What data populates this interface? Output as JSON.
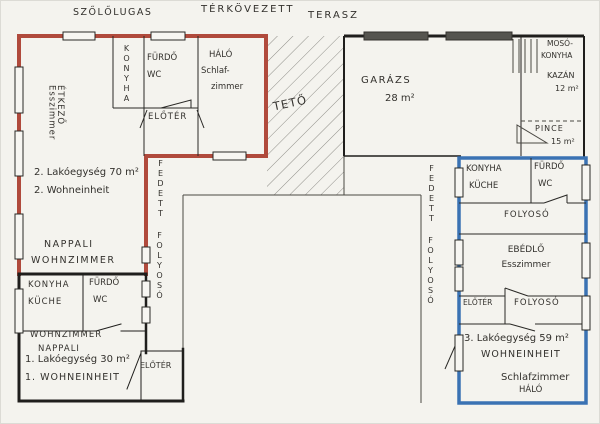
{
  "drawing": {
    "kind": "hand-drawn floor plan",
    "colors": {
      "unit2_outline": "#b04a3c",
      "unit3_outline": "#3a72b3",
      "black_walls": "#1f1e1c",
      "paper": "#f4f3ee",
      "roof_hatch": "#8f8e88",
      "garage_door_fill": "#55544f"
    },
    "outdoor": {
      "pergola": "SZŐLŐLUGAS",
      "paving": "TÉRKÖVEZETT",
      "terrace": "TERASZ",
      "roof": "TETŐ",
      "corridor_left_1": "FEDETT",
      "corridor_left_2": "FOLYOSÓ",
      "corridor_right_1": "FEDETT",
      "corridor_right_2": "FOLYOSÓ"
    },
    "unit2": {
      "kitchen": "KONYHA",
      "bath_1": "FÜRDŐ",
      "bath_2": "WC",
      "bedroom_1": "HÁLÓ",
      "bedroom_2": "Schlaf-",
      "bedroom_3": "zimmer",
      "dining_hu": "ÉTKEZŐ",
      "dining_de": "Esszimmer",
      "hall": "ELŐTÉR",
      "title_1": "2. Lakóegység 70 m²",
      "title_2": "2. Wohneinheit",
      "living_1": "NAPPALI",
      "living_2": "WOHNZIMMER"
    },
    "unit1": {
      "kitchen_1": "KONYHA",
      "kitchen_2": "KÜCHE",
      "bath_1": "FÜRDŐ",
      "bath_2": "WC",
      "living_1": "WOHNZIMMER",
      "living_2": "NAPPALI",
      "title_1": "1. Lakóegység 30 m²",
      "title_2": "1. WOHNEINHEIT",
      "hall": "ELŐTÉR"
    },
    "garage": {
      "name": "GARÁZS",
      "area": "28 m²"
    },
    "utility": {
      "laundry_1": "MOSÓ-",
      "laundry_2": "KONYHA",
      "boiler": "KAZÁN",
      "boiler_area": "12 m²",
      "cellar": "PINCE",
      "cellar_area": "15 m²"
    },
    "unit3": {
      "kitchen_1": "KONYHA",
      "kitchen_2": "KÜCHE",
      "bath_1": "FÜRDŐ",
      "bath_2": "WC",
      "corridor_a": "FOLYOSÓ",
      "dining_1": "EBÉDLŐ",
      "dining_2": "Esszimmer",
      "hall": "ELŐTÉR",
      "corridor_b": "FOLYOSÓ",
      "title_1": "3. Lakóegység 59 m²",
      "title_2": "WOHNEINHEIT",
      "bedroom_1": "Schlafzimmer",
      "bedroom_2": "HÁLÓ"
    }
  }
}
